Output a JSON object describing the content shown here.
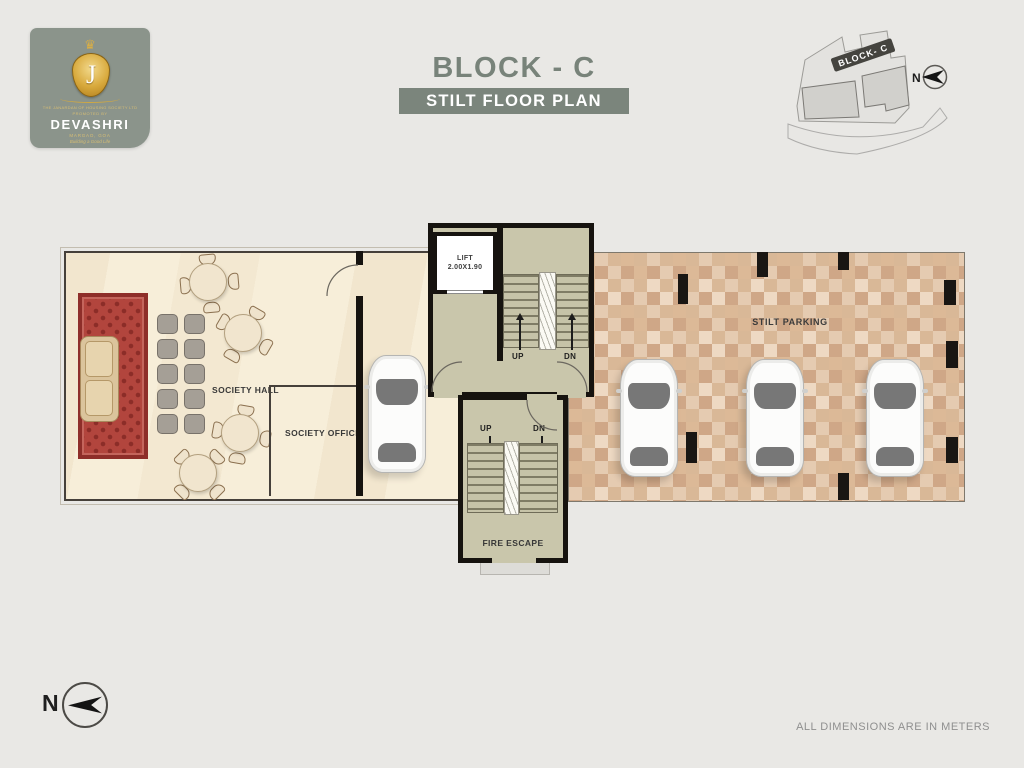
{
  "header": {
    "logo": {
      "crown_icon": "crown",
      "monogram": "J",
      "society_line1": "THE JANARDAN OF HOUSING SOCIETY LTD",
      "society_line2": "PROMOTED BY",
      "brand": "DEVASHRI",
      "location_line": "MARGAO, GOA",
      "tagline": "Building a Good Life"
    },
    "title": "BLOCK - C",
    "subtitle": "STILT FLOOR PLAN",
    "keyplan": {
      "block_label": "BLOCK- C",
      "north_label": "N"
    }
  },
  "plan": {
    "society_hall_label": "SOCIETY HALL",
    "society_office_label": "SOCIETY OFFICE",
    "lift_label": "LIFT",
    "lift_size": "2.00X1.90",
    "main_stairs": {
      "up": "UP",
      "dn": "DN"
    },
    "fire_stairs": {
      "up": "UP",
      "dn": "DN",
      "label": "FIRE ESCAPE"
    },
    "parking_label": "STILT PARKING"
  },
  "footer": {
    "north_label": "N",
    "note": "ALL DIMENSIONS ARE IN METERS"
  },
  "colors": {
    "accent_sage": "#7b857c",
    "logo_bg": "#8b948b",
    "gold": "#d8a93c",
    "hall_floor": "#f7eed9",
    "stair_floor": "#c9c6ab",
    "parking_floor": "#e5cbb1",
    "carpet_red": "#b2453d",
    "wall_black": "#16130f"
  }
}
